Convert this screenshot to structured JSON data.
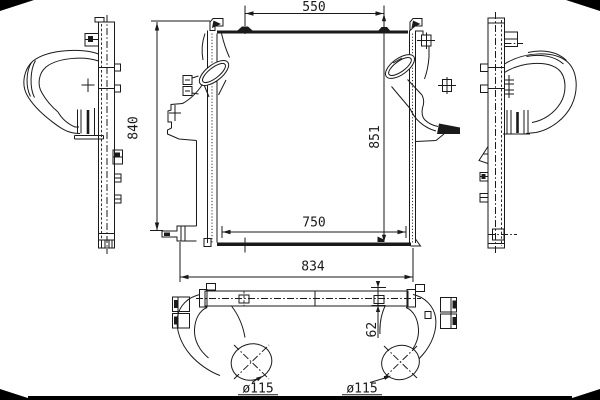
{
  "colors": {
    "ink": "#1a1a1a",
    "paper": "#ffffff",
    "frame": "#000000"
  },
  "dims": {
    "top_width": "550",
    "left_height": "840",
    "right_height": "851",
    "core_width": "750",
    "overall_width": "834",
    "pipe_offset": "62",
    "pipe_diameter_left": "ø115",
    "pipe_diameter_right": "ø115"
  }
}
